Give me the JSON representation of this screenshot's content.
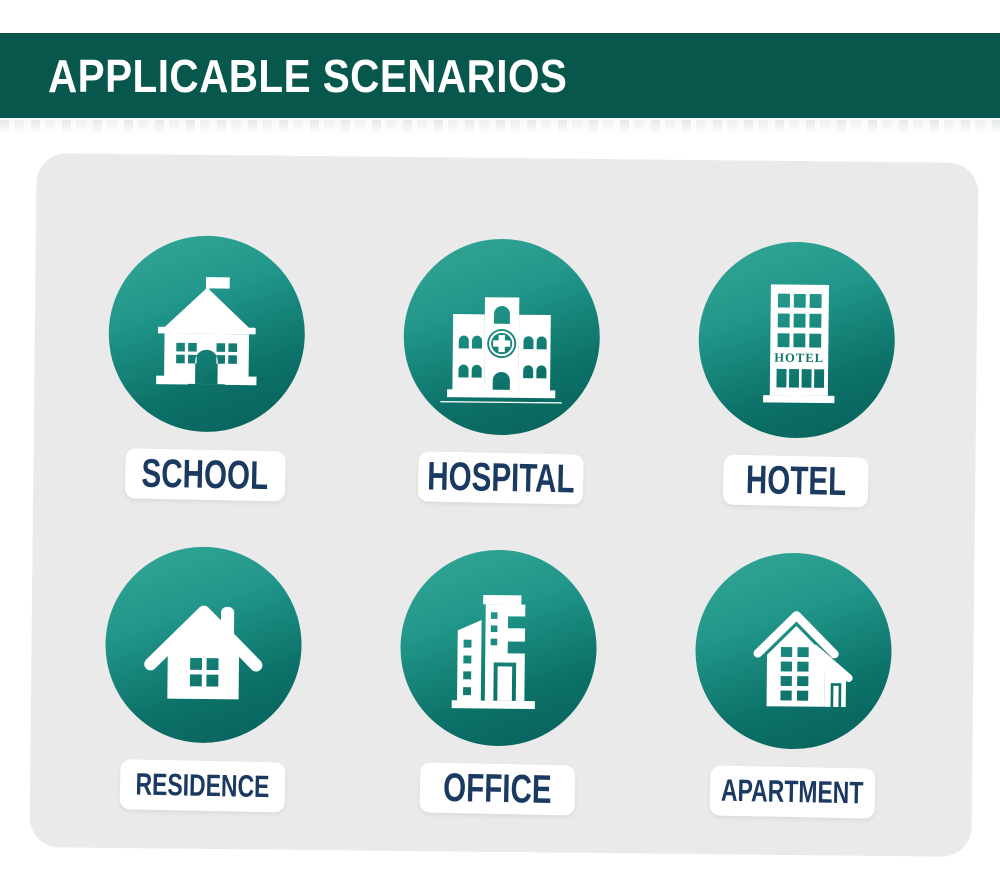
{
  "header": {
    "title": "APPLICABLE SCENARIOS",
    "bg_color": "#07574d",
    "text_color": "#ffffff"
  },
  "panel": {
    "bg_color": "#e9eae9",
    "tilt_degrees": 0.6
  },
  "scenarios": [
    {
      "label": "SCHOOL",
      "icon": "school-building-icon",
      "label_size": "large"
    },
    {
      "label": "HOSPITAL",
      "icon": "hospital-building-icon",
      "label_size": "large"
    },
    {
      "label": "HOTEL",
      "icon": "hotel-building-icon",
      "label_size": "large"
    },
    {
      "label": "RESIDENCE",
      "icon": "residence-house-icon",
      "label_size": "small"
    },
    {
      "label": "OFFICE",
      "icon": "office-building-icon",
      "label_size": "large"
    },
    {
      "label": "APARTMENT",
      "icon": "apartment-building-icon",
      "label_size": "small"
    }
  ],
  "hotel_sign": "HOTEL",
  "colors": {
    "circle_gradient_top": "#35a896",
    "circle_gradient_bottom": "#07605a",
    "icon_fill": "#ffffff",
    "label_text": "#1a3a62",
    "hotel_sign_text": "#0d756b"
  }
}
